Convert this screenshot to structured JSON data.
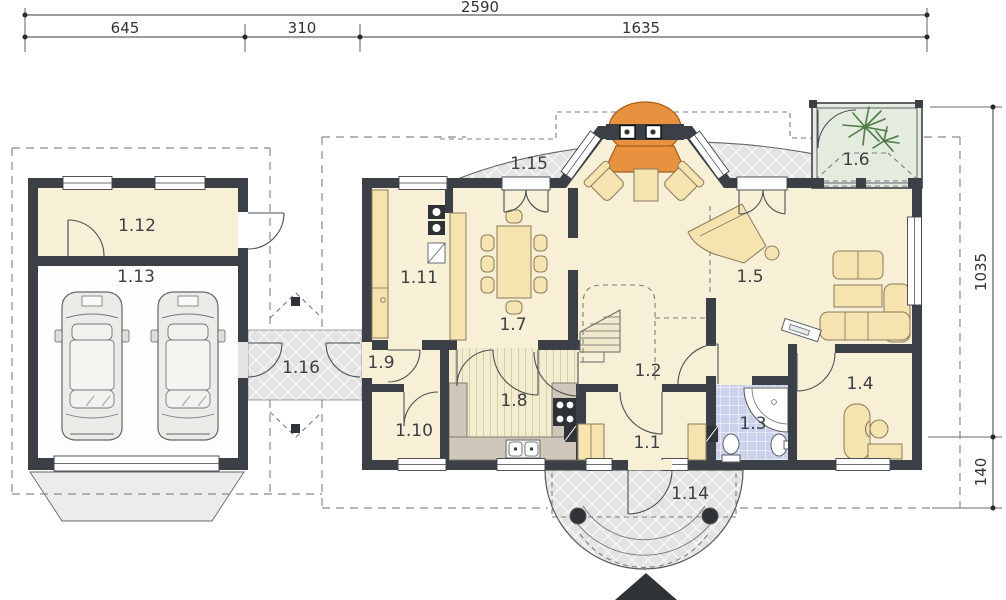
{
  "dimensions": {
    "top": {
      "total": "2590",
      "segments": [
        "645",
        "310",
        "1635"
      ]
    },
    "right": {
      "segments": [
        "1035",
        "140"
      ]
    }
  },
  "rooms": [
    {
      "label": "1.1"
    },
    {
      "label": "1.2"
    },
    {
      "label": "1.3"
    },
    {
      "label": "1.4"
    },
    {
      "label": "1.5"
    },
    {
      "label": "1.6"
    },
    {
      "label": "1.7"
    },
    {
      "label": "1.8"
    },
    {
      "label": "1.9"
    },
    {
      "label": "1.10"
    },
    {
      "label": "1.11"
    },
    {
      "label": "1.12"
    },
    {
      "label": "1.13"
    },
    {
      "label": "1.14"
    },
    {
      "label": "1.15"
    },
    {
      "label": "1.16"
    }
  ],
  "colors": {
    "wall": "#3b4046",
    "floor_cream": "#f7f0d6",
    "terrace_gray": "#e3e3e4",
    "bath_tile": "#ccd2ec",
    "kitchen_counter": "#cfc7ba",
    "furniture_tan": "#f5e3b0",
    "fireplace_orange": "#e8913f",
    "conservatory_green": "#e4ebdf",
    "plant_green": "#4e7d46"
  },
  "icons": {
    "car": "top-view car shape",
    "plant": "branch burst",
    "north_arrow": "▲",
    "fireplace": "semicircular hearth"
  }
}
